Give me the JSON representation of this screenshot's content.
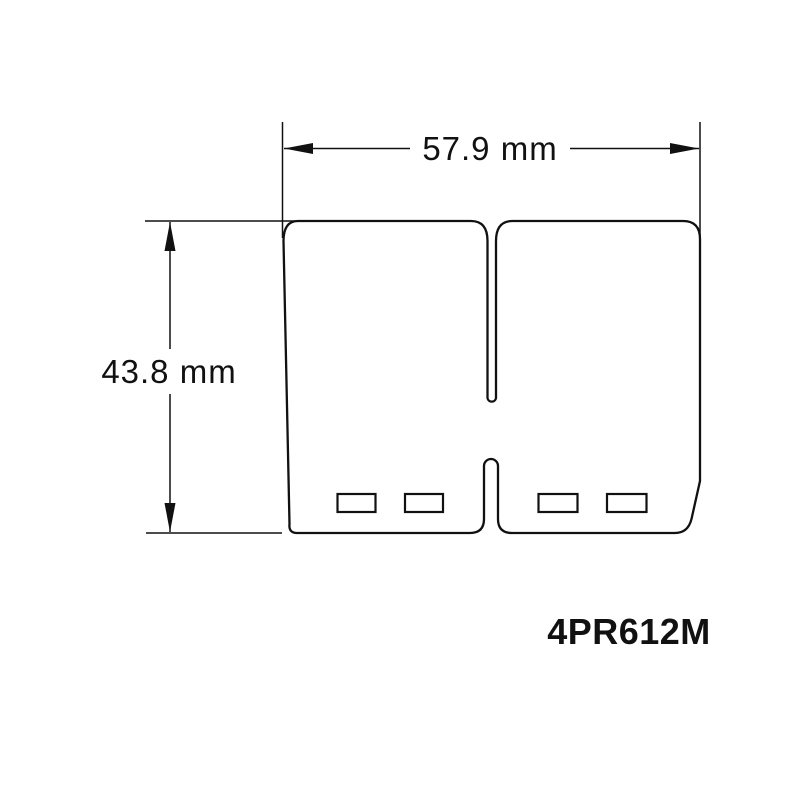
{
  "diagram": {
    "type": "technical-dimension-drawing",
    "subject": "reed-valve-petal-pair",
    "part_number": "4PR612M",
    "dimensions": {
      "width": {
        "label": "57.9 mm",
        "value_mm": 57.9
      },
      "height": {
        "label": "43.8 mm",
        "value_mm": 43.8
      }
    },
    "features": {
      "hole_count": 4,
      "top_slot": "central narrow slot from top edge",
      "bottom_notch": "central narrow notch rising from bottom edge"
    },
    "colors": {
      "line": "#111111",
      "background": "#ffffff"
    }
  }
}
